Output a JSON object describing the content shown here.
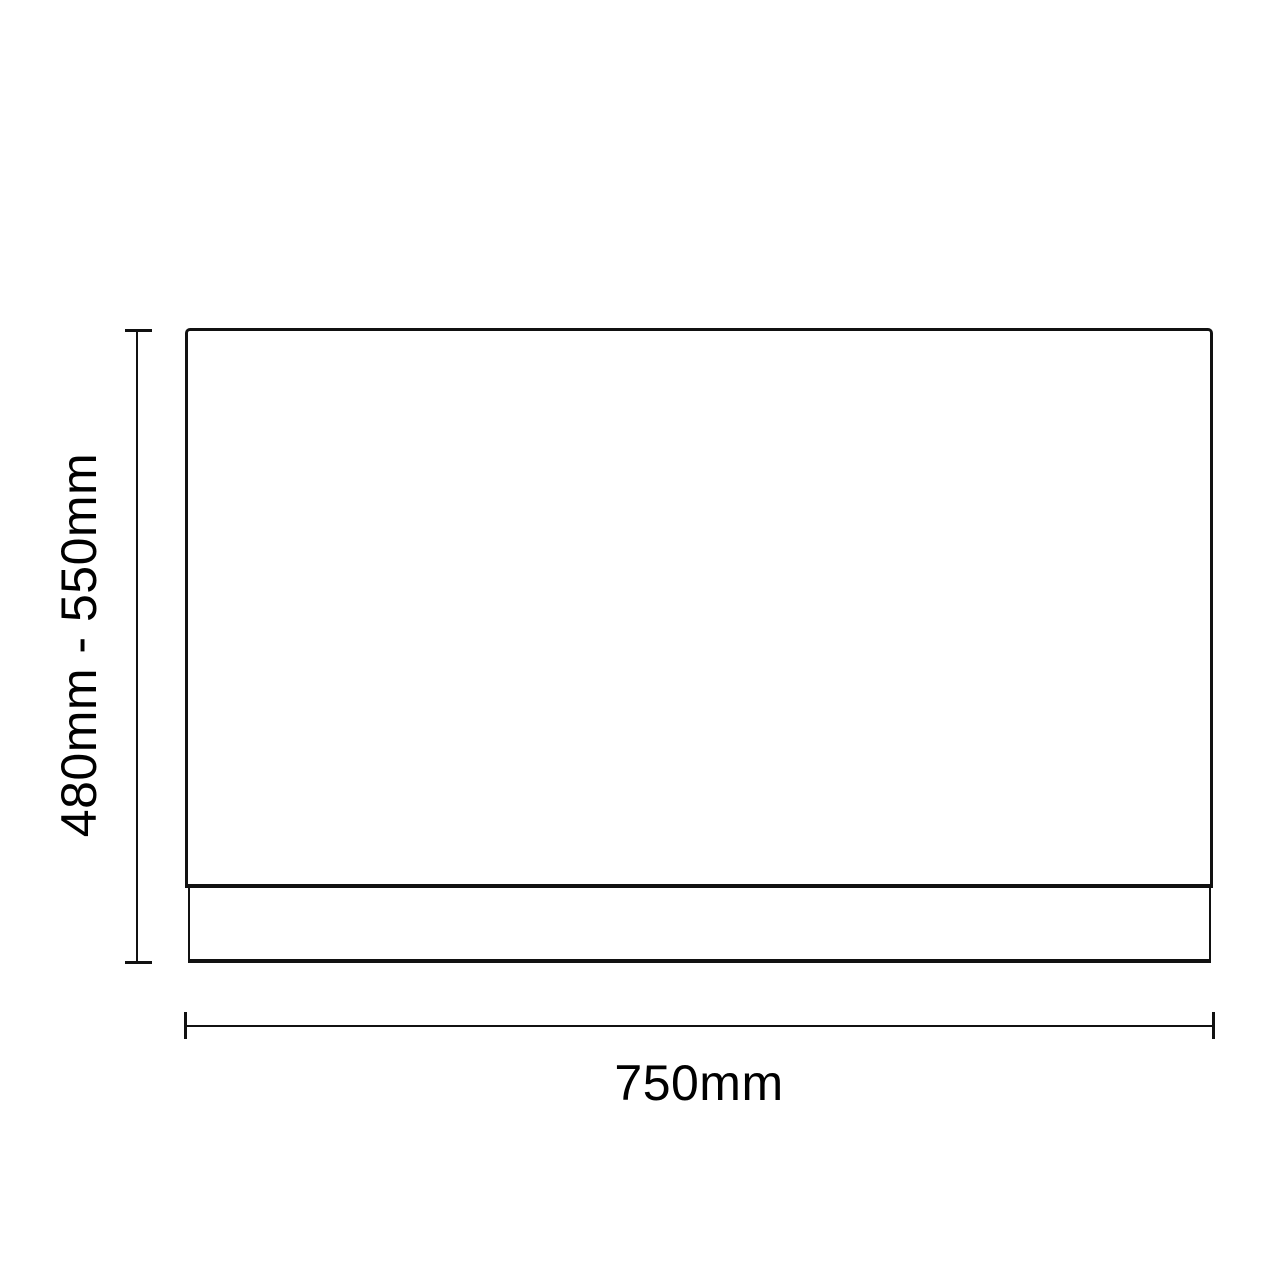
{
  "diagram": {
    "height_dimension": {
      "label": "480mm - 550mm"
    },
    "width_dimension": {
      "label": "750mm"
    },
    "colors": {
      "line": "#111111",
      "text": "#000000",
      "background": "#ffffff"
    }
  }
}
